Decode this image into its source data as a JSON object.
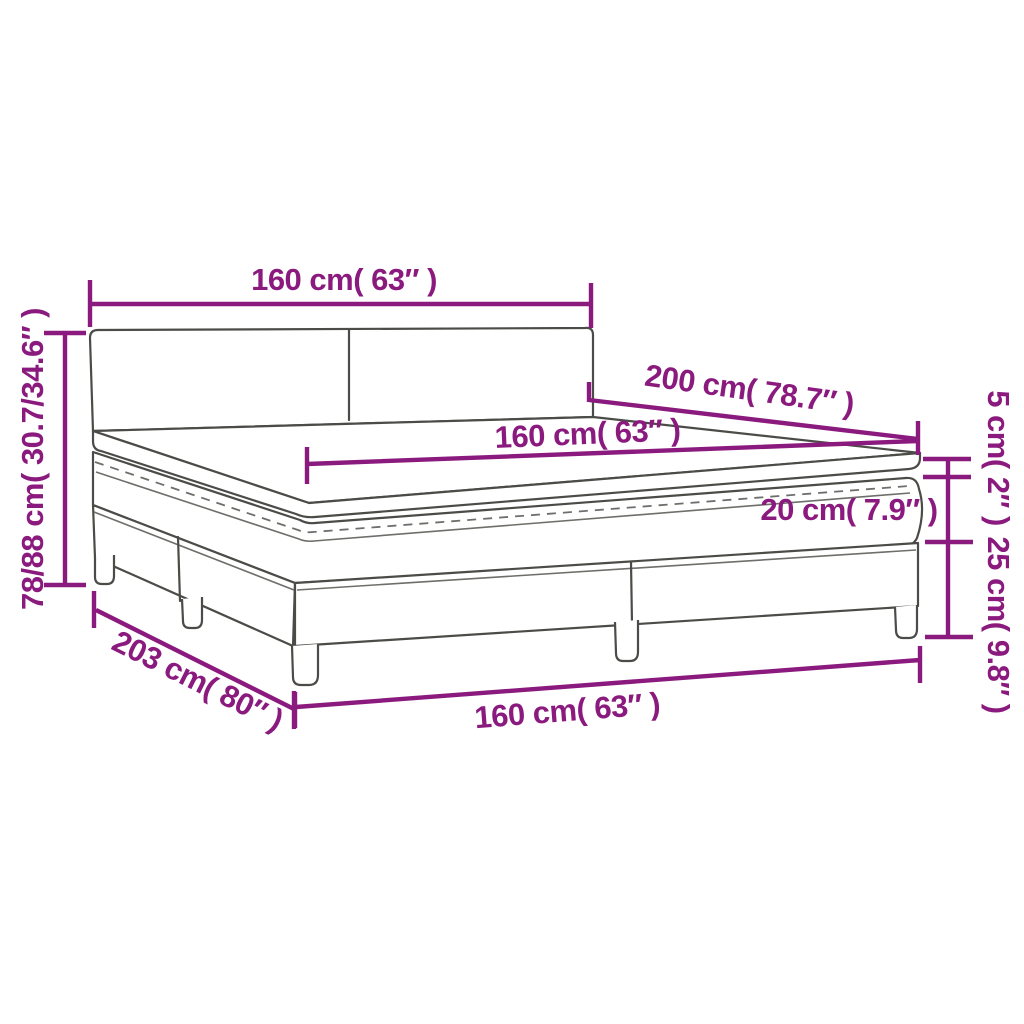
{
  "diagram": {
    "colors": {
      "dimension": "#8B1A7E",
      "outline": "#4B4B47",
      "background": "#FFFFFF"
    },
    "dimensions": {
      "headboard_width": "160 cm( 63″ )",
      "bed_length": "200 cm( 78.7″ )",
      "mattress_width": "160 cm( 63″ )",
      "mattress_height": "20 cm( 7.9″ )",
      "topper_height": "5 cm( 2″ )",
      "base_height": "25 cm( 9.8″ )",
      "total_height": "78/88 cm( 30.7/34.6″ )",
      "total_length": "203 cm( 80″ )",
      "base_width": "160 cm( 63″ )"
    }
  }
}
